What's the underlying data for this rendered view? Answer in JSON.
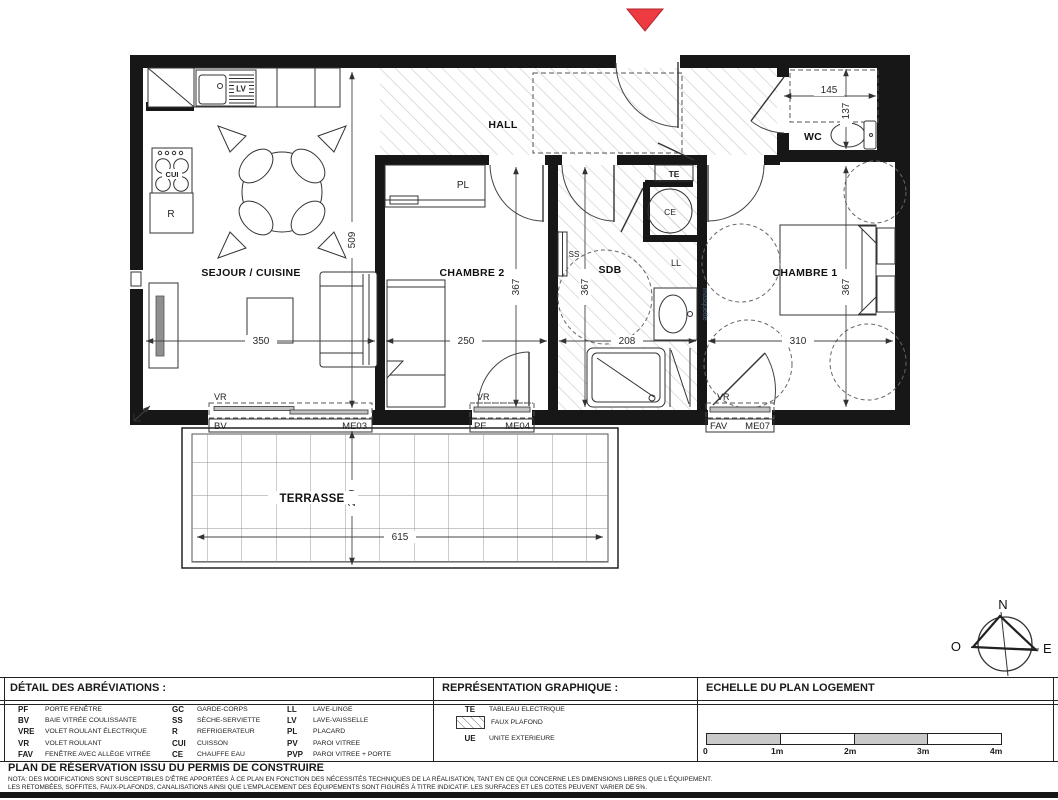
{
  "colors": {
    "wall": "#171717",
    "hatch": "#cdcdcd",
    "marker_red": "#ee3a41",
    "scale_gray": "#c9c9c9"
  },
  "plan": {
    "rooms": {
      "sejour": "SEJOUR / CUISINE",
      "hall": "HALL",
      "wc": "WC",
      "chambre2": "CHAMBRE 2",
      "sdb": "SDB",
      "chambre1": "CHAMBRE 1",
      "terrasse": "TERRASSE"
    },
    "labels": {
      "pl": "PL",
      "te": "TE",
      "ce": "CE",
      "ss": "SS",
      "ll": "LL",
      "lv": "LV",
      "cui": "CUI",
      "fridge": "R",
      "vasque_note": "masquette"
    },
    "dims": {
      "sejour_w": "350",
      "sejour_h": "509",
      "chambre2_w": "250",
      "chambre2_h": "367",
      "sdb_w": "208",
      "sdb_h": "367",
      "chambre1_w": "310",
      "chambre1_h": "367",
      "wc_w": "145",
      "wc_h": "137",
      "terrasse_w": "615",
      "terrasse_h": "210"
    },
    "windows": {
      "sejour": {
        "vr": "VR",
        "code": "BV",
        "ref": "ME03"
      },
      "chambre2": {
        "vr": "VR",
        "code": "PF",
        "ref": "ME04"
      },
      "chambre1": {
        "vr": "VR",
        "code": "FAV",
        "ref": "ME07"
      }
    }
  },
  "compass": {
    "north": "N",
    "east": "E",
    "south": "S",
    "west": "O"
  },
  "legend": {
    "abbreviations_title": "DÉTAIL DES ABRÉVIATIONS :",
    "abbreviation_columns": [
      {
        "rows": [
          {
            "abbr": "PF",
            "label": "PORTE FENÊTRE"
          },
          {
            "abbr": "BV",
            "label": "BAIE VITRÉE COULISSANTE"
          },
          {
            "abbr": "VRE",
            "label": "VOLET ROULANT ÉLECTRIQUE"
          },
          {
            "abbr": "VR",
            "label": "VOLET ROULANT"
          },
          {
            "abbr": "FAV",
            "label": "FENÊTRE AVEC ALLÈGE VITRÉE"
          }
        ]
      },
      {
        "rows": [
          {
            "abbr": "GC",
            "label": "GARDE-CORPS"
          },
          {
            "abbr": "SS",
            "label": "SÈCHE-SERVIETTE"
          },
          {
            "abbr": "R",
            "label": "REFRIGERATEUR"
          },
          {
            "abbr": "CUI",
            "label": "CUISSON"
          },
          {
            "abbr": "CE",
            "label": "CHAUFFE EAU"
          }
        ]
      },
      {
        "rows": [
          {
            "abbr": "LL",
            "label": "LAVE-LINGE"
          },
          {
            "abbr": "LV",
            "label": "LAVE-VAISSELLE"
          },
          {
            "abbr": "PL",
            "label": "PLACARD"
          },
          {
            "abbr": "PV",
            "label": "PAROI VITREE"
          },
          {
            "abbr": "PVP",
            "label": "PAROI VITREE + PORTE"
          }
        ]
      }
    ],
    "graphics_title": "REPRÉSENTATION GRAPHIQUE :",
    "graphics_rows": [
      {
        "key": "TE",
        "label": "TABLEAU ELECTRIQUE"
      },
      {
        "key": "",
        "label": "FAUX PLAFOND"
      },
      {
        "key": "UE",
        "label": "UNITE EXTERIEURE"
      }
    ],
    "scale_title": "ECHELLE DU PLAN LOGEMENT",
    "scale_ticks": [
      "0",
      "1m",
      "2m",
      "3m",
      "4m"
    ]
  },
  "footer": {
    "title": "PLAN DE RÉSERVATION ISSU DU PERMIS DE CONSTRUIRE",
    "nota_line1": "NOTA: DES MODIFICATIONS SONT SUSCEPTIBLES D'ÊTRE APPORTÉES À CE PLAN EN FONCTION DES NÉCESSITÉS TECHNIQUES DE LA RÉALISATION, TANT EN CE QUI CONCERNE LES DIMENSIONS LIBRES QUE L'ÉQUIPEMENT.",
    "nota_line2": "LES RETOMBÉES, SOFFITES, FAUX-PLAFONDS, CANALISATIONS AINSI QUE L'EMPLACEMENT DES ÉQUIPEMENTS SONT FIGURÉS À TITRE INDICATIF. LES SURFACES ET LES COTES PEUVENT VARIER DE 5%."
  }
}
